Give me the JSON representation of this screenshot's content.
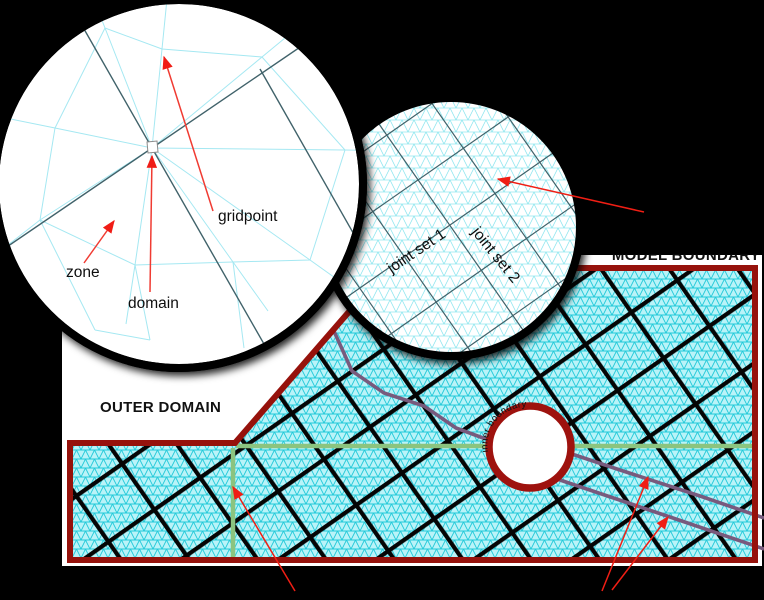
{
  "figure": {
    "background_color": "#000000",
    "labels": {
      "outer_domain": "OUTER DOMAIN",
      "model_boundary": "MODEL BOUNDARY",
      "inner_boundary": "inner boundary"
    },
    "left_inset": {
      "labels": {
        "zone": "zone",
        "domain": "domain",
        "gridpoint": "gridpoint"
      }
    },
    "right_inset": {
      "labels": {
        "joint_set_1": "joint set 1",
        "joint_set_2": "joint set 2"
      }
    },
    "colors": {
      "model_boundary_red": "#96120c",
      "inner_boundary_red": "#9e120e",
      "mesh_cyan": "#21c9d9",
      "mesh_bg": "#b9f3f8",
      "joint_black": "#050505",
      "green_line": "#8bc47f",
      "purple_joint_trace": "#785a7d",
      "annotation_red": "#f01e14",
      "inset_joint_gray": "#41626a",
      "inset_mesh_cyan": "#35d2e2"
    }
  }
}
